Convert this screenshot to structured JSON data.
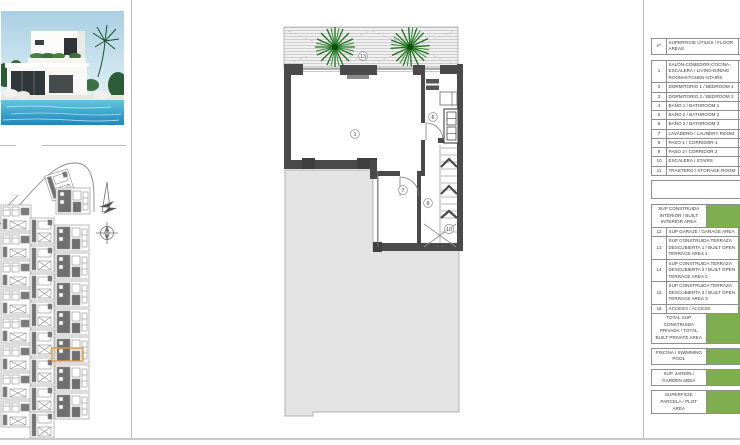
{
  "legend_table": {
    "header": {
      "num": "nº",
      "label": "SUPERFICIE ÚTILES / FLOOR AREAS"
    },
    "rooms": [
      {
        "num": "1",
        "label": "SALÓN-COMEDOR-COCINA-ESCALERA / LIVING-DINING ROOM-KITCHEN-STAIRS"
      },
      {
        "num": "2",
        "label": "DORMITORIO 1 / BEDROOM 1"
      },
      {
        "num": "3",
        "label": "DORMITORIO 2 / BEDROOM 2"
      },
      {
        "num": "4",
        "label": "BAÑO 1 / BATHROOM 1"
      },
      {
        "num": "5",
        "label": "BAÑO 2 / BATHROOM 2"
      },
      {
        "num": "6",
        "label": "BAÑO 3 / BATHROOM 3"
      },
      {
        "num": "7",
        "label": "LAVADERO / LAUNDRY ROOM"
      },
      {
        "num": "8",
        "label": "PASO 1 / CORRIDOR 1"
      },
      {
        "num": "9",
        "label": "PASO 2 / CORRIDOR 2"
      },
      {
        "num": "10",
        "label": "ESCALERA / STAIRS"
      },
      {
        "num": "11",
        "label": "TRASTERO / STORAGE ROOM"
      }
    ],
    "built_section": {
      "header": "SUP CONSTRUIDA INTERIOR / BUILT INTERIOR AREA",
      "rows": [
        {
          "num": "12",
          "label": "SUP GARAJE / GARAGE AREA"
        },
        {
          "num": "13",
          "label": "SUP CONSTRUIDA TERRAZA DESCUBIERTA 1 / BUILT OPEN TERRACE AREA 1"
        },
        {
          "num": "14",
          "label": "SUP CONSTRUIDA TERRAZA DESCUBIERTA 2 / BUILT OPEN TERRACE AREA 2"
        },
        {
          "num": "15",
          "label": "SUP CONSTRUIDA TERRAZA DESCUBIERTA 3 / BUILT OPEN TERRACE AREA 3"
        },
        {
          "num": "16",
          "label": "ACCESO / ACCESS"
        }
      ],
      "total": "TOTAL SUP CONSTRUIDA PRIVADA / TOTAL BUILT PRIVATE AREA"
    },
    "summary_rows": [
      "PISCINA / SWIMMING POOL",
      "SUP. JARDÍN / GARDEN AREA",
      "SUPERFICIE PARCELA / PLOT AREA"
    ]
  },
  "floor_plan": {
    "labels": {
      "terrace": "13",
      "living_room": "1",
      "bathroom3": "6",
      "laundry": "7",
      "corridor2": "9",
      "stairs": "10"
    }
  },
  "colors": {
    "accent_green": "#7fae4f",
    "highlight_orange": "#e09c3c",
    "wall_dark": "#4a4a4a"
  }
}
